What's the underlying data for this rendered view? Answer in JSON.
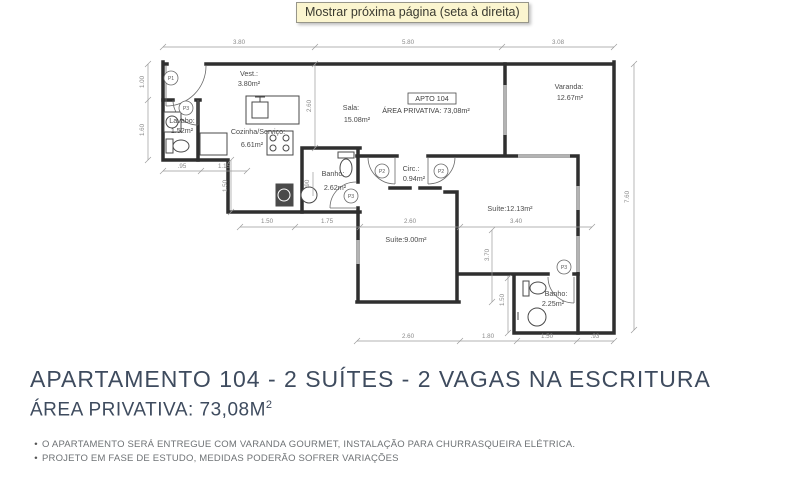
{
  "tooltip": "Mostrar próxima página (seta à direita)",
  "plan": {
    "unit": {
      "tag": "APTO 104",
      "area_line": "ÁREA PRIVATIVA: 73,08m²"
    },
    "rooms": {
      "vest": {
        "name": "Vest.:",
        "area": "3.80m²"
      },
      "lavabo": {
        "name": "Lavabo:",
        "area": "1.52m²"
      },
      "cozinha": {
        "name": "Cozinha/Serviço:",
        "area": "6.61m²"
      },
      "sala": {
        "name": "Sala:",
        "area": "15.08m²"
      },
      "varanda": {
        "name": "Varanda:",
        "area": "12.67m²"
      },
      "circ": {
        "name": "Circ.:",
        "area": "0.94m²"
      },
      "banho_social": {
        "name": "Banho:",
        "area": "2.62m²"
      },
      "suite1": {
        "label": "Suíte:9.00m²"
      },
      "suite2": {
        "label": "Suíte:12.13m²"
      },
      "banho_suite": {
        "name": "Banho:",
        "area": "2.25m²"
      }
    },
    "doors": {
      "p1": "P1",
      "p2": "P2",
      "p3": "P3"
    },
    "dims": {
      "top": [
        "3.80",
        "5.80",
        "3.08"
      ],
      "left": [
        "1.00",
        "1.60"
      ],
      "lavabo_row": [
        ".95",
        "1.15"
      ],
      "mid_row": [
        "1.50",
        "1.75",
        "2.60",
        "3.40"
      ],
      "bottom_row": [
        "2.60",
        "1.80",
        "1.50",
        ".93"
      ],
      "sala_v": "2.60",
      "kitchen_v": "1.50",
      "banho_v": ".90",
      "suite_v": "3.70",
      "banho2_v": "1.50",
      "right_v": "7.60"
    }
  },
  "footer": {
    "title": "APARTAMENTO 104 - 2 SUÍTES - 2 VAGAS NA ESCRITURA",
    "area_label": "ÁREA PRIVATIVA: 73,08M",
    "area_sup": "2",
    "bullet": "•",
    "notes": [
      "O APARTAMENTO SERÁ ENTREGUE COM VARANDA GOURMET, INSTALAÇÃO PARA CHURRASQUEIRA ELÉTRICA.",
      "PROJETO EM FASE DE ESTUDO, MEDIDAS PODERÃO SOFRER VARIAÇÕES"
    ]
  }
}
